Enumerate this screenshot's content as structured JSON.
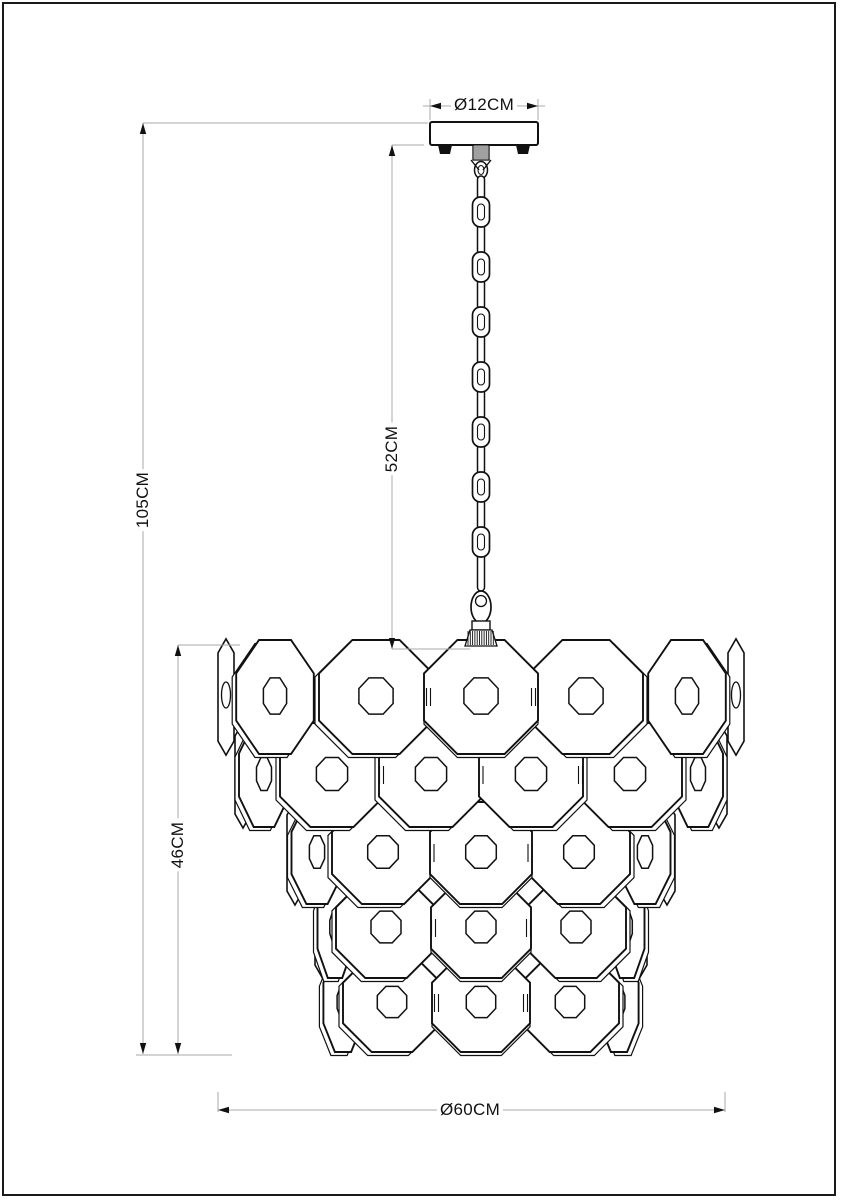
{
  "page": {
    "background": "#ffffff",
    "border_color": "#1a1a1a",
    "line_color": "#111111",
    "dim_line_color": "#a9a9a9",
    "text_color": "#111111"
  },
  "diagram": {
    "kind": "chandelier-dimension-drawing",
    "labels": {
      "canopy_diameter": "Ø12CM",
      "total_height": "105CM",
      "chain_drop": "52CM",
      "body_height": "46CM",
      "body_diameter": "Ø60CM"
    }
  }
}
